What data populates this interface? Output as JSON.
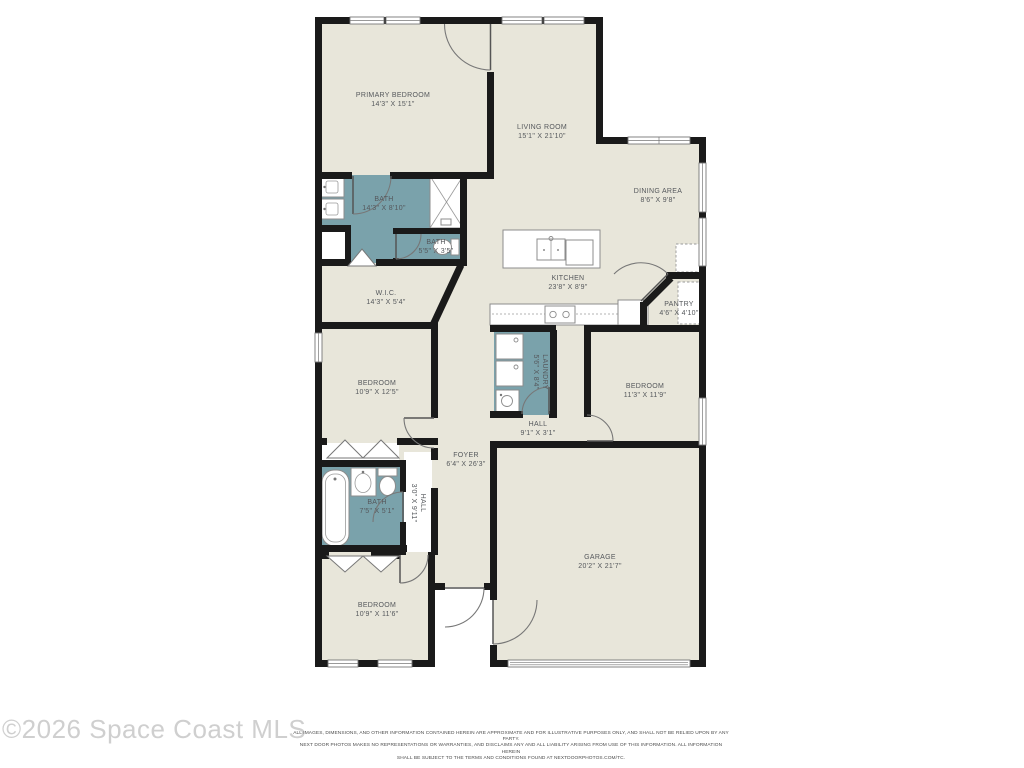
{
  "colors": {
    "floor": "#e8e6da",
    "wet": "#7aa2ab",
    "wall": "#1a1a1a"
  },
  "rooms": [
    {
      "id": "primary-bedroom",
      "name": "PRIMARY BEDROOM",
      "dims": "14'3\" X 15'1\""
    },
    {
      "id": "living-room",
      "name": "LIVING ROOM",
      "dims": "15'1\" X 21'10\""
    },
    {
      "id": "dining-area",
      "name": "DINING AREA",
      "dims": "8'6\" X 9'8\""
    },
    {
      "id": "primary-bath",
      "name": "BATH",
      "dims": "14'3\" X 8'10\""
    },
    {
      "id": "bath-2",
      "name": "BATH",
      "dims": "5'5\" X 3'5\""
    },
    {
      "id": "wic",
      "name": "W.I.C.",
      "dims": "14'3\" X 5'4\""
    },
    {
      "id": "kitchen",
      "name": "KITCHEN",
      "dims": "23'8\" X 8'9\""
    },
    {
      "id": "pantry",
      "name": "PANTRY",
      "dims": "4'6\" X 4'10\""
    },
    {
      "id": "bedroom-1",
      "name": "BEDROOM",
      "dims": "10'9\" X 12'5\""
    },
    {
      "id": "laundry",
      "name": "LAUNDRY",
      "dims": "5'6\" X 8'4\""
    },
    {
      "id": "bedroom-2",
      "name": "BEDROOM",
      "dims": "11'3\" X 11'9\""
    },
    {
      "id": "hall",
      "name": "HALL",
      "dims": "9'1\" X 3'1\""
    },
    {
      "id": "foyer",
      "name": "FOYER",
      "dims": "6'4\" X 26'3\""
    },
    {
      "id": "hall-2",
      "name": "HALL",
      "dims": "3'0\" X 9'11\""
    },
    {
      "id": "bath-3",
      "name": "BATH",
      "dims": "7'5\" X 5'1\""
    },
    {
      "id": "bedroom-3",
      "name": "BEDROOM",
      "dims": "10'9\" X 11'6\""
    },
    {
      "id": "garage",
      "name": "GARAGE",
      "dims": "20'2\" X 21'7\""
    }
  ],
  "footer": {
    "watermark": "©2026 Space Coast MLS",
    "disclaimer": [
      "ALL IMAGES, DIMENSIONS, AND OTHER INFORMATION CONTAINED HEREIN ARE APPROXIMATE AND FOR ILLUSTRATIVE PURPOSES ONLY, AND SHALL NOT BE RELIED UPON BY ANY PARTY.",
      "NEXT DOOR PHOTOS MAKES NO REPRESENTATIONS OR WARRANTIES, AND DISCLAIMS ANY AND ALL LIABILITY ARISING FROM USE OF THIS INFORMATION. ALL INFORMATION HEREIN",
      "SHALL BE SUBJECT TO THE TERMS AND CONDITIONS FOUND AT NEXTDOORPHOTOS.COM/TC."
    ]
  }
}
